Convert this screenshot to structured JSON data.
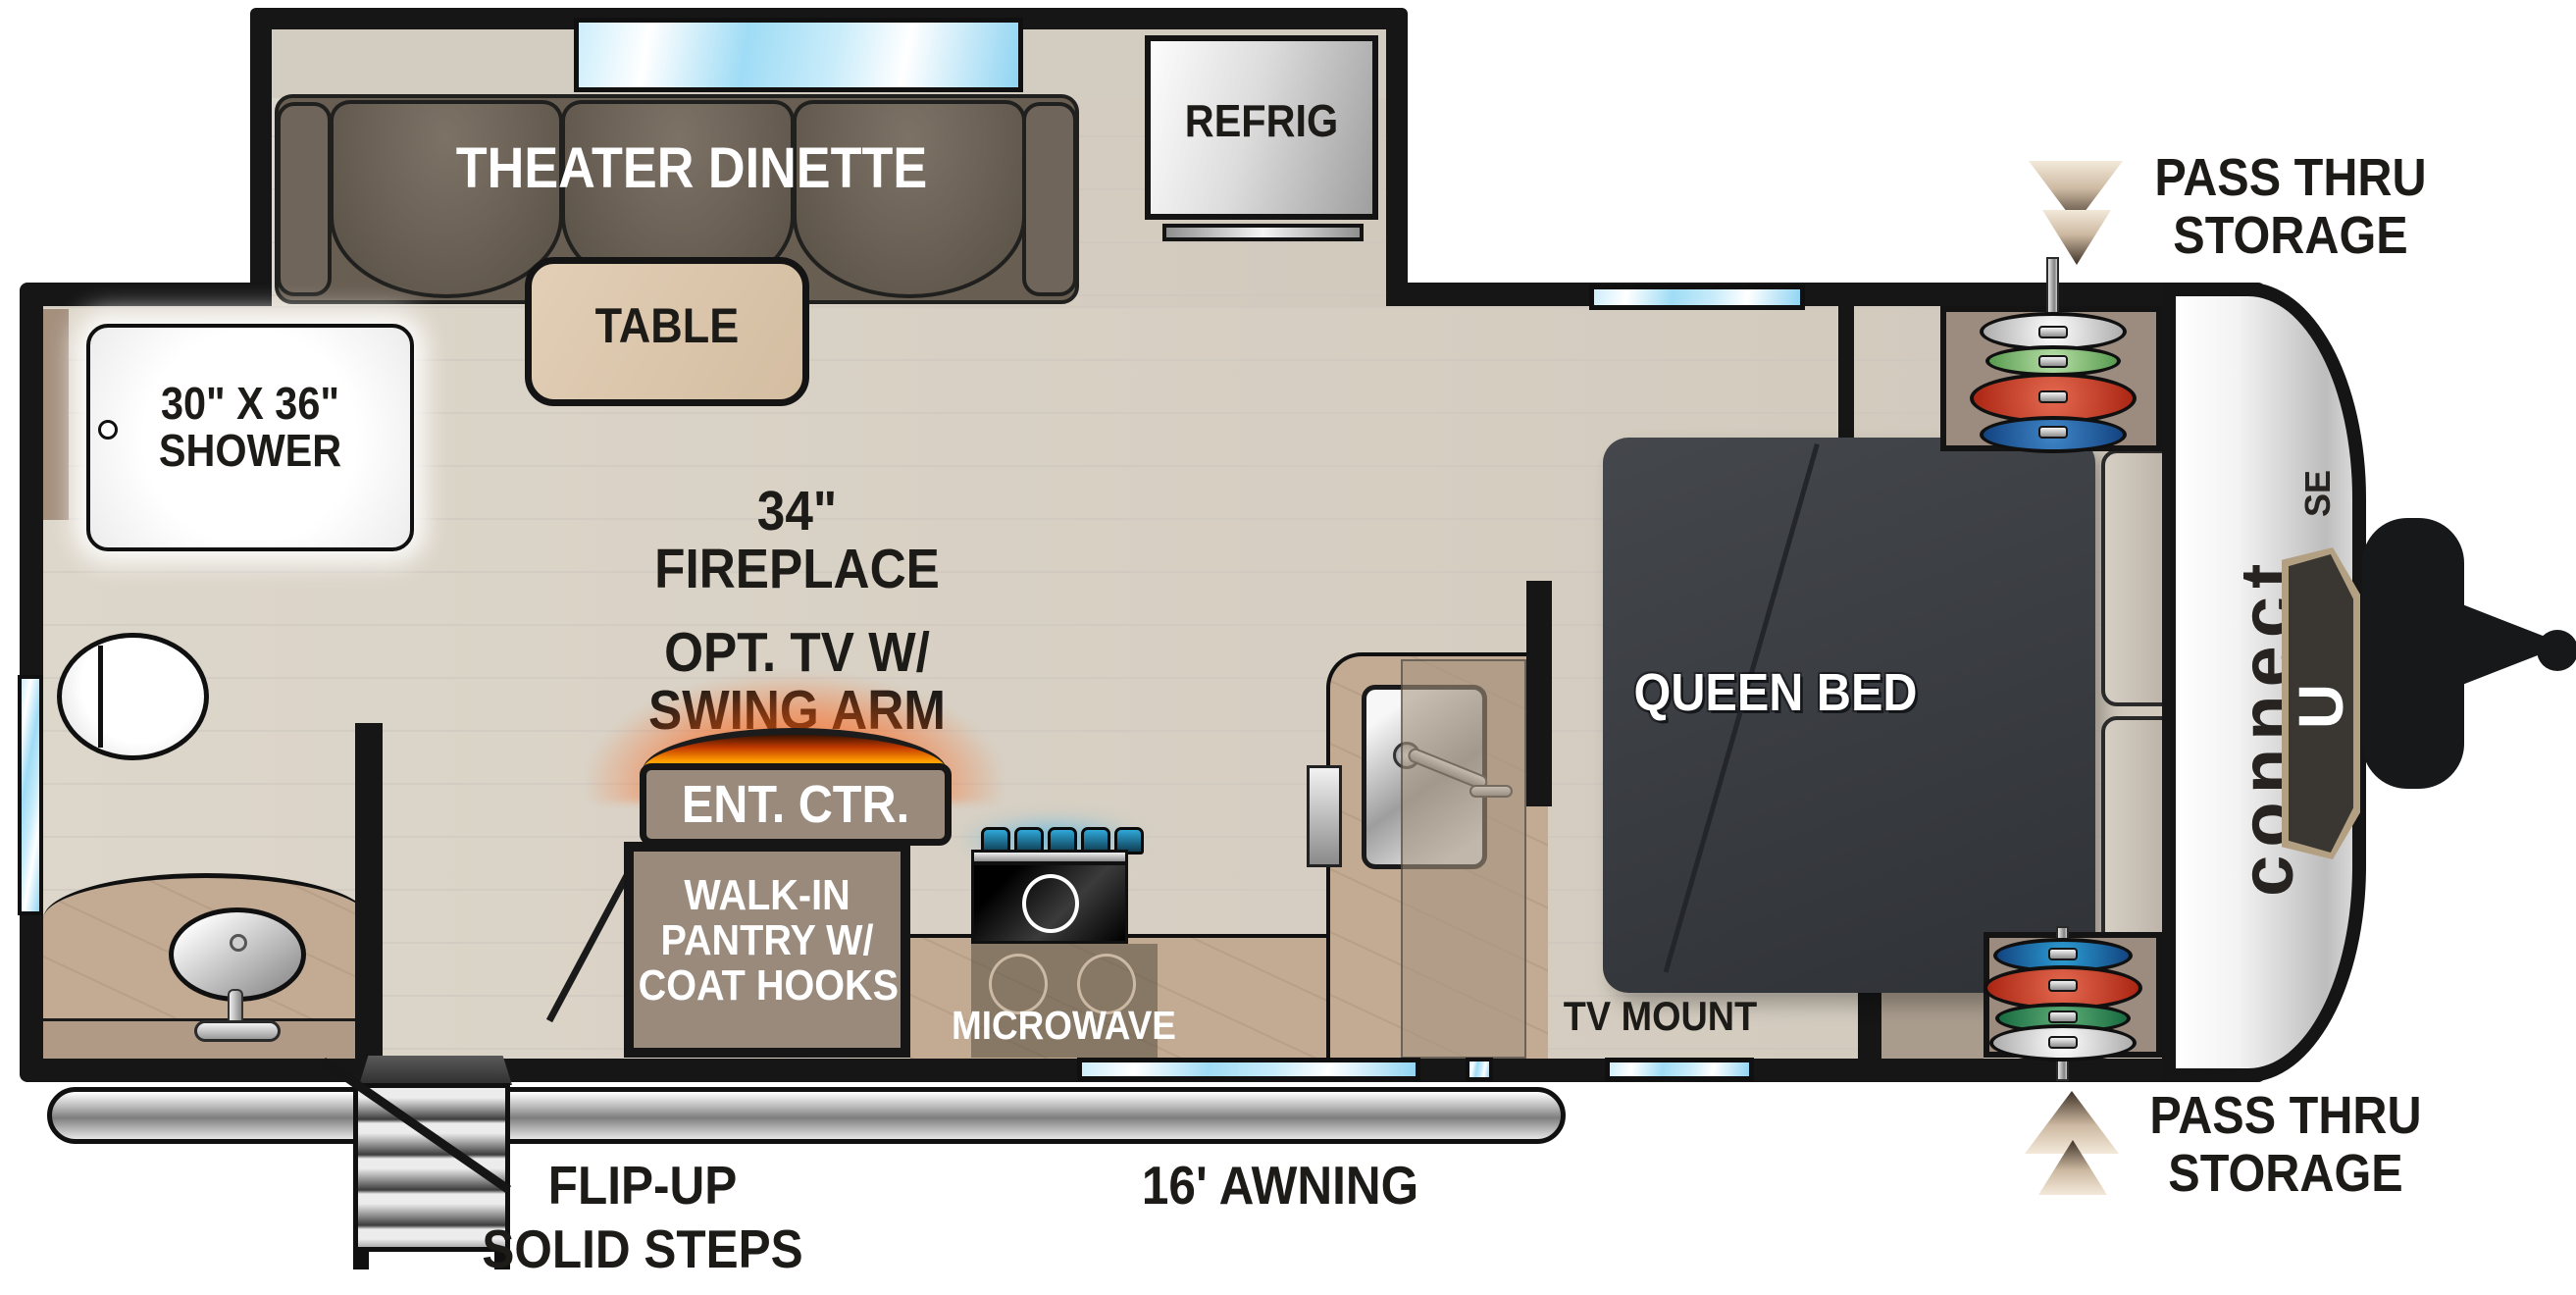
{
  "title": "Connect SE travel trailer floor plan",
  "labels": {
    "theater_dinette": "THEATER DINETTE",
    "table": "TABLE",
    "refrig": "REFRIG",
    "shower_line1": "30\" X 36\"",
    "shower_line2": "SHOWER",
    "fireplace_line1": "34\"",
    "fireplace_line2": "FIREPLACE",
    "tv_line1": "OPT. TV W/",
    "tv_line2": "SWING ARM",
    "ent_ctr": "ENT. CTR.",
    "pantry_line1": "WALK-IN",
    "pantry_line2": "PANTRY W/",
    "pantry_line3": "COAT HOOKS",
    "microwave": "MICROWAVE",
    "queen_bed": "QUEEN BED",
    "tv_mount": "TV MOUNT",
    "pass_thru_top_line1": "PASS THRU",
    "pass_thru_top_line2": "STORAGE",
    "pass_thru_bottom_line1": "PASS THRU",
    "pass_thru_bottom_line2": "STORAGE",
    "steps_line1": "FLIP-UP",
    "steps_line2": "SOLID STEPS",
    "awning": "16' AWNING"
  },
  "logo": {
    "brand": "connect",
    "series": "SE",
    "badge_letter": "U"
  },
  "colors": {
    "wall": "#161616",
    "floor_wood": "#d8d1c6",
    "counter_marble": "#c2aa93",
    "cabinet_brown": "#998a7c",
    "sofa_brown": "#6a5f53",
    "bed_dark": "#3b3e43",
    "window_blue": "#9fdcf5",
    "accent_gold": "#b3a083",
    "fire_glow": "#ff5a1f",
    "knob_blue": "#2fa8d8"
  }
}
